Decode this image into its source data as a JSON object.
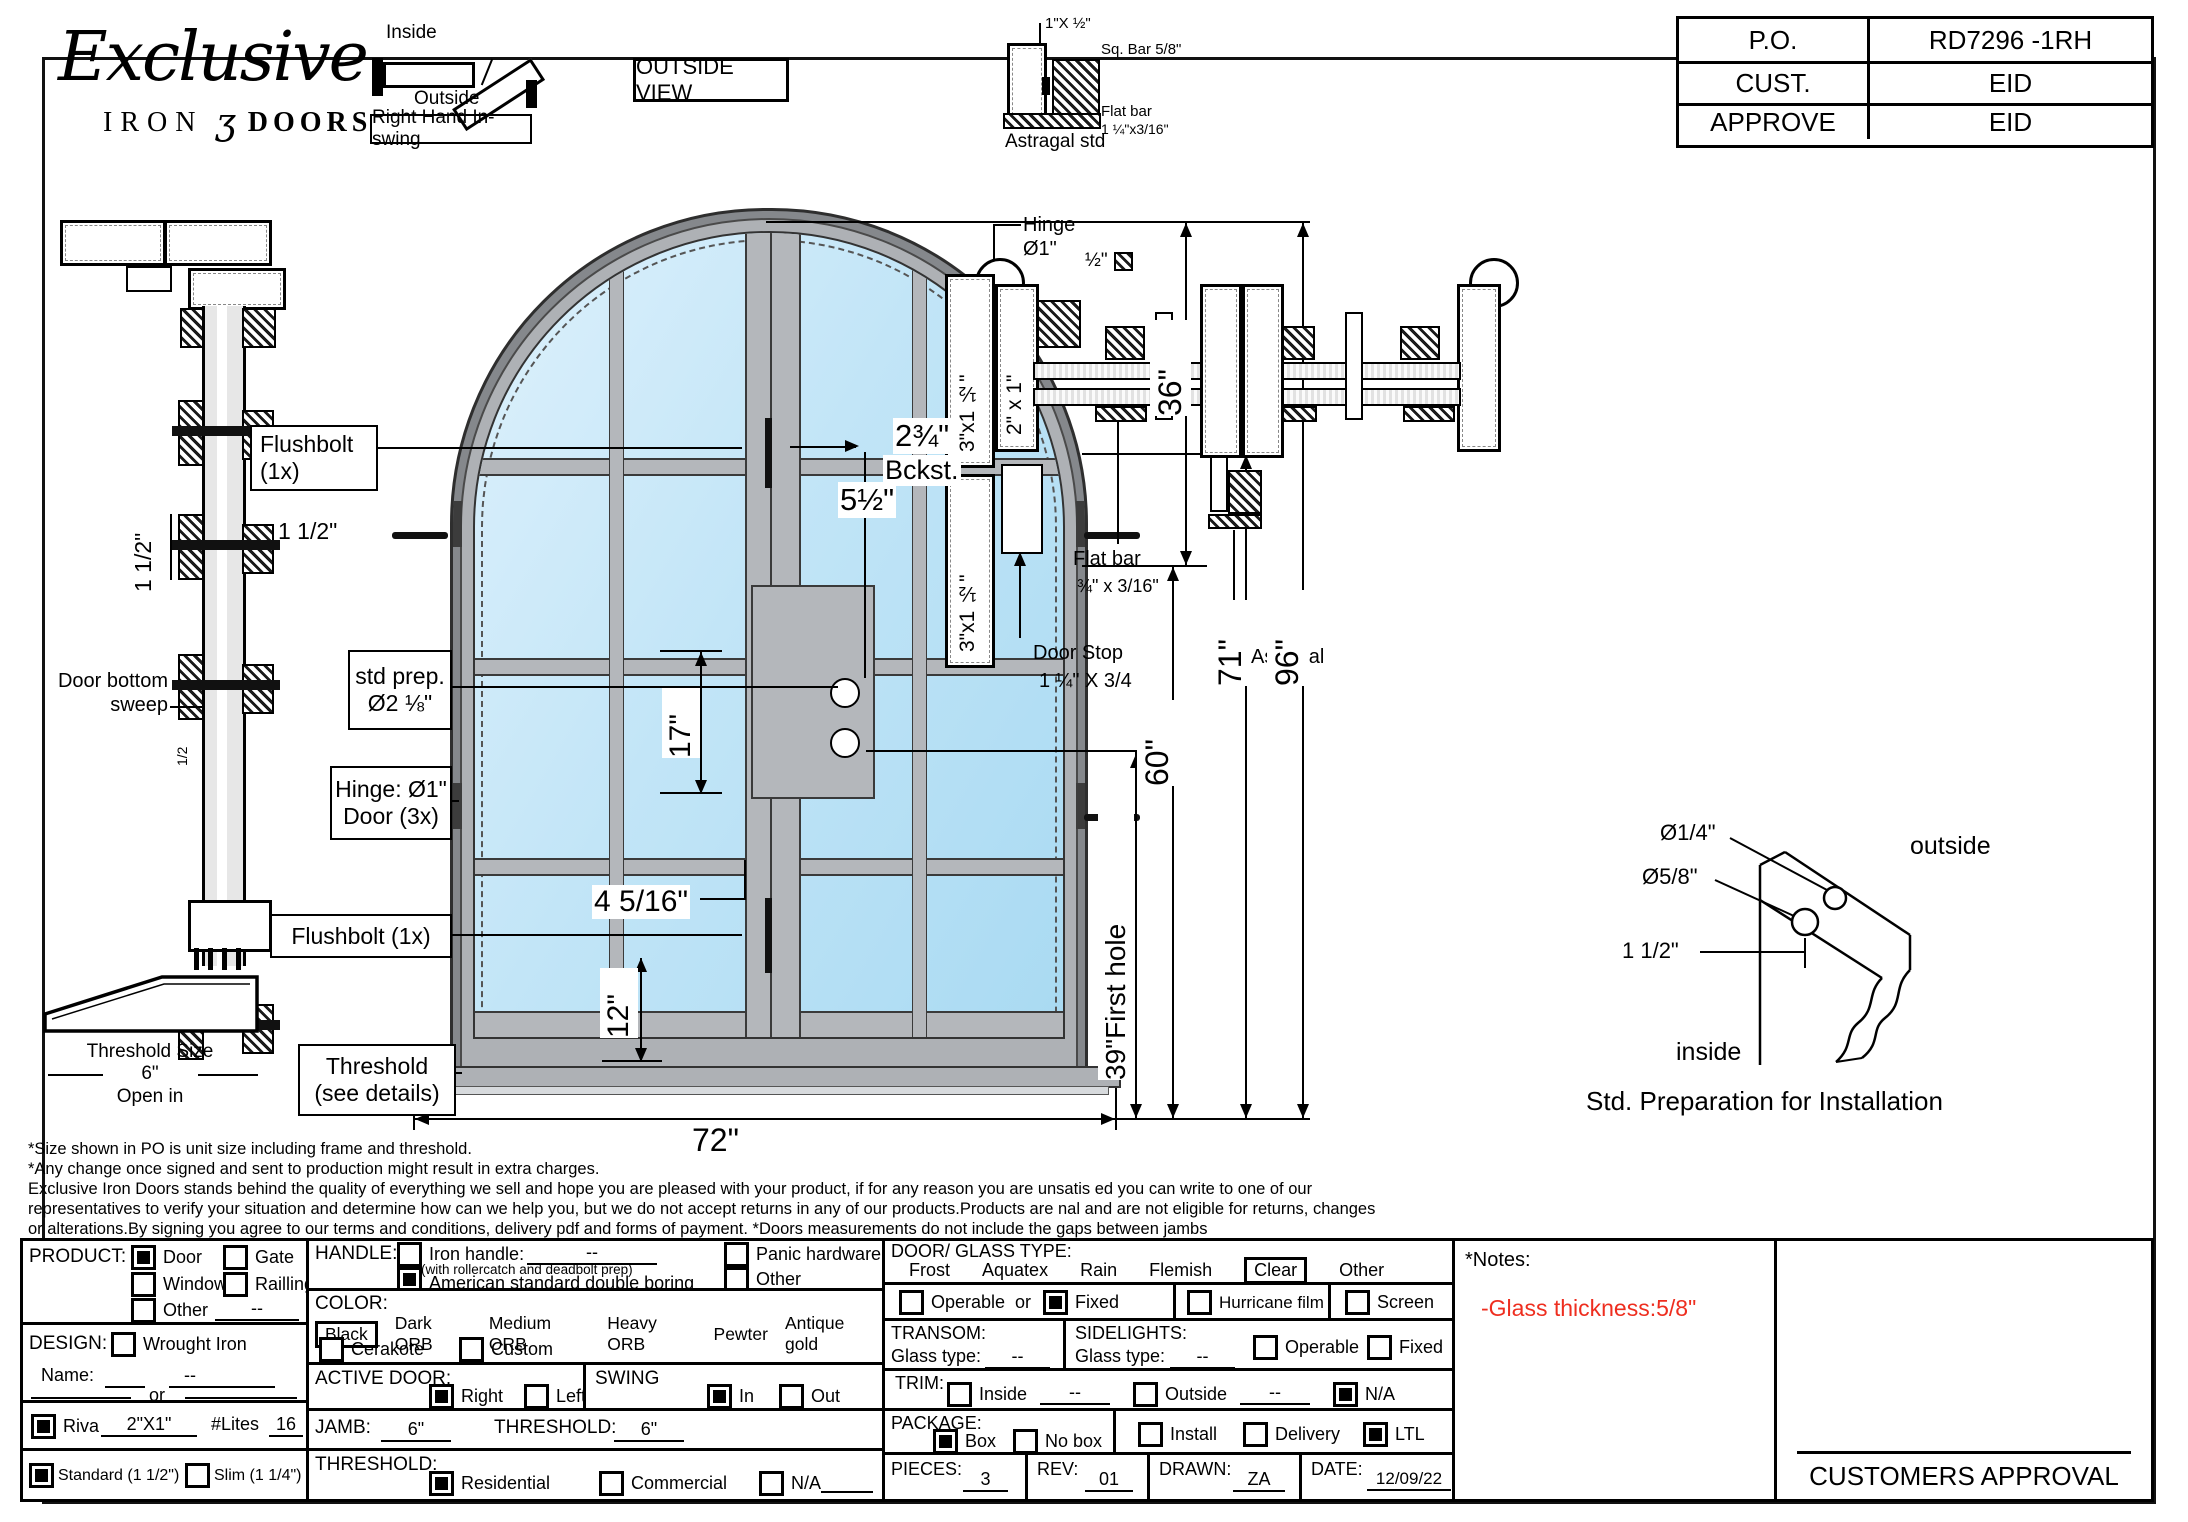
{
  "colors": {
    "glass": "#bfe3f5",
    "frame_gray": "#b3b6ba",
    "note_red": "#ee2e1f"
  },
  "logo": {
    "script": "Exclusive",
    "iron": "IRON",
    "ornament": "ʒ",
    "doors": "DOORS"
  },
  "swing": {
    "inside": "Inside",
    "outside": "Outside",
    "tag": "Right Hand In-swing"
  },
  "view_label": "OUTSIDE VIEW",
  "title_block": {
    "po_label": "P.O.",
    "po_value": "RD7296 -1RH",
    "cust_label": "CUST.",
    "cust_value": "EID",
    "approve_label": "APPROVE",
    "approve_value": "EID"
  },
  "astragal_detail": {
    "dim": "1\"X ½\"",
    "sq_bar": "Sq. Bar 5/8\"",
    "flat_bar_line1": "Flat bar",
    "flat_bar_line2": "1 ¼\"x3/16\"",
    "caption": "Astragal std"
  },
  "jamb_detail": {
    "dim_rotated": "1 1/2\"",
    "dim_horizontal": "1 1/2\"",
    "sweep_line1": "Door bottom",
    "sweep_line2": "sweep",
    "half": "1/2",
    "threshold_line1": "Threshold Size",
    "threshold_line2": "6\"",
    "threshold_line3": "Open in"
  },
  "elevation": {
    "flushbolt_top_line1": "Flushbolt",
    "flushbolt_top_line2": "(1x)",
    "stdprep_line1": "std prep.",
    "stdprep_line2": "Ø2 ⅛\"",
    "hinge_line1": "Hinge: Ø1\"",
    "hinge_line2": "Door (3x)",
    "flushbolt_bottom": "Flushbolt (1x)",
    "threshold_line1": "Threshold",
    "threshold_line2": "(see details)",
    "dim_backset": "2¾\"",
    "dim_backset_label": "Bckst.",
    "dim_5_5": "5½\"",
    "dim_17": "17\"",
    "dim_4_5_16": "4 5/16\"",
    "dim_12": "12\"",
    "dim_72": "72\"",
    "dim_36": "36\"",
    "dim_96": "96\"",
    "dim_71": "71\"",
    "dim_60": "60\"",
    "dim_39": "39\"First hole"
  },
  "plan": {
    "hinge_line1": "Hinge",
    "hinge_line2": "Ø1\"",
    "half_square": "½\"",
    "frame_tube_top": "3\"x1 ½\"",
    "frame_tube_bottom": "3\"x1 ½\"",
    "door_tube": "2\" x 1\"",
    "flat_bar_line1": "Flat bar",
    "flat_bar_line2": "¾\" x 3/16\"",
    "door_stop_line1": "Door Stop",
    "door_stop_line2": "1 ¼\" X 3/4",
    "astragal": "Astragal"
  },
  "install": {
    "dia_quarter": "Ø1/4\"",
    "dia_five_eighths": "Ø5/8\"",
    "dim": "1 1/2\"",
    "outside": "outside",
    "inside": "inside",
    "caption": "Std. Preparation for Installation"
  },
  "disclaimer": {
    "line1": "*Size shown in PO is unit size including frame and threshold.",
    "line2": "*Any change once signed and sent to production might result in extra charges.",
    "line3": "Exclusive Iron Doors stands behind the quality of everything we sell and hope you are pleased with your product, if for any reason you are unsatis ed you can write to one of our",
    "line4": "representatives to verify your situation and determine how can we help you, but we do not accept returns in any of our products.Products are  nal and are not eligible for returns, changes",
    "line5": "or alterations.By signing you agree to our terms and conditions, delivery pdf and forms of payment. *Doors measurements do not include the gaps between jambs"
  },
  "form": {
    "product": {
      "label": "PRODUCT:",
      "door": "Door",
      "gate": "Gate",
      "window": "Window",
      "railling": "Railling",
      "other": "Other",
      "other_value": "--"
    },
    "design": {
      "label": "DESIGN:",
      "wrought": "Wrought Iron",
      "name_label": "Name:",
      "name_value": "--",
      "or": "or",
      "riva": "Riva",
      "riva_value": "2\"X1\"",
      "lites_label": "#Lites",
      "lites_value": "16",
      "standard": "Standard (1 1/2\")",
      "slim": "Slim (1 1/4\")"
    },
    "handle": {
      "label": "HANDLE:",
      "iron": "Iron handle:",
      "iron_value": "--",
      "iron_note": "(with rollercatch and deadbolt prep)",
      "american": "American standard double boring",
      "panic": "Panic hardware",
      "other": "Other"
    },
    "color": {
      "label": "COLOR:",
      "black": "Black",
      "dark": "Dark ORB",
      "medium": "Medium ORB",
      "heavy": "Heavy ORB",
      "pewter": "Pewter",
      "antique": "Antique gold",
      "cerakote": "Cerakote",
      "custom": "Custom"
    },
    "active": {
      "label": "ACTIVE DOOR:",
      "right": "Right",
      "left": "Left"
    },
    "swing": {
      "label": "SWING",
      "in": "In",
      "out": "Out"
    },
    "jamb": {
      "label": "JAMB:",
      "value": "6\"",
      "thr_label": "THRESHOLD:",
      "thr_value": "6\""
    },
    "threshold": {
      "label": "THRESHOLD:",
      "residential": "Residential",
      "commercial": "Commercial",
      "na": "N/A"
    },
    "glass": {
      "label": "DOOR/ GLASS TYPE:",
      "frost": "Frost",
      "aquatex": "Aquatex",
      "rain": "Rain",
      "flemish": "Flemish",
      "clear": "Clear",
      "other": "Other",
      "operable": "Operable",
      "or": "or",
      "fixed": "Fixed",
      "hurricane": "Hurricane film",
      "screen": "Screen"
    },
    "transom": {
      "label": "TRANSOM:",
      "glass_label": "Glass type:",
      "glass_value": "--"
    },
    "sidelights": {
      "label": "SIDELIGHTS:",
      "glass_label": "Glass type:",
      "glass_value": "--",
      "operable": "Operable",
      "fixed": "Fixed"
    },
    "trim": {
      "label": "TRIM:",
      "inside": "Inside",
      "inside_value": "--",
      "outside": "Outside",
      "outside_value": "--",
      "na": "N/A"
    },
    "package": {
      "label": "PACKAGE:",
      "box": "Box",
      "nobox": "No box",
      "install": "Install",
      "delivery": "Delivery",
      "ltl": "LTL"
    },
    "meta": {
      "pieces_label": "PIECES:",
      "pieces": "3",
      "rev_label": "REV:",
      "rev": "01",
      "drawn_label": "DRAWN:",
      "drawn": "ZA",
      "date_label": "DATE:",
      "date": "12/09/22"
    }
  },
  "form_state": {
    "product": "Door",
    "design_riva": true,
    "design_standard": true,
    "handle": "American standard double boring",
    "color": "Black",
    "active_door": "Right",
    "swing": "In",
    "jamb": "6\"",
    "threshold_size": "6\"",
    "threshold": "Residential",
    "glass_type": "Clear",
    "glass_mode": "Fixed",
    "trim": "N/A",
    "package": "Box",
    "shipping": "LTL"
  },
  "notes": {
    "title": "*Notes:",
    "glass_note": "-Glass thickness:5/8\"",
    "note_style": "color:#ee2e1f"
  },
  "approval_label": "CUSTOMERS APPROVAL"
}
